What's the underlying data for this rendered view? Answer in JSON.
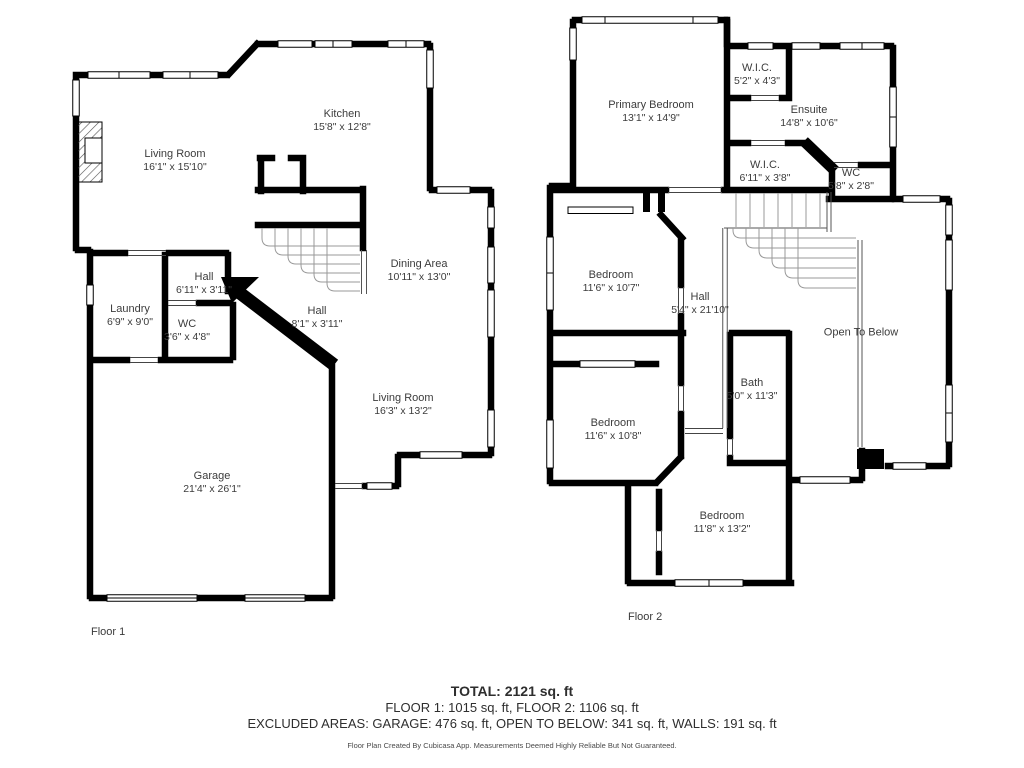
{
  "floor1": {
    "caption": "Floor 1",
    "rooms": {
      "living_room": {
        "name": "Living Room",
        "dims": "16'1\" x 15'10\""
      },
      "kitchen": {
        "name": "Kitchen",
        "dims": "15'8\" x 12'8\""
      },
      "dining_area": {
        "name": "Dining Area",
        "dims": "10'11\" x 13'0\""
      },
      "hall_small": {
        "name": "Hall",
        "dims": "6'11\" x 3'11\""
      },
      "laundry": {
        "name": "Laundry",
        "dims": "6'9\" x 9'0\""
      },
      "wc": {
        "name": "WC",
        "dims": "3'6\" x 4'8\""
      },
      "hall_diag": {
        "name": "Hall",
        "dims": "8'1\" x 3'11\""
      },
      "living_room2": {
        "name": "Living Room",
        "dims": "16'3\" x 13'2\""
      },
      "garage": {
        "name": "Garage",
        "dims": "21'4\" x 26'1\""
      }
    }
  },
  "floor2": {
    "caption": "Floor 2",
    "rooms": {
      "primary_bedroom": {
        "name": "Primary Bedroom",
        "dims": "13'1\" x 14'9\""
      },
      "wic1": {
        "name": "W.I.C.",
        "dims": "5'2\" x 4'3\""
      },
      "ensuite": {
        "name": "Ensuite",
        "dims": "14'8\" x 10'6\""
      },
      "wic2": {
        "name": "W.I.C.",
        "dims": "6'11\" x 3'8\""
      },
      "wc": {
        "name": "WC",
        "dims": "5'8\" x 2'8\""
      },
      "bedroom1": {
        "name": "Bedroom",
        "dims": "11'6\" x 10'7\""
      },
      "hall": {
        "name": "Hall",
        "dims": "5'4\" x 21'10\""
      },
      "open_to_below": {
        "name": "Open To Below"
      },
      "bedroom2": {
        "name": "Bedroom",
        "dims": "11'6\" x 10'8\""
      },
      "bath": {
        "name": "Bath",
        "dims": "5'0\" x 11'3\""
      },
      "bedroom3": {
        "name": "Bedroom",
        "dims": "11'8\" x 13'2\""
      }
    }
  },
  "summary": {
    "total": "TOTAL: 2121 sq. ft",
    "floors": "FLOOR 1: 1015 sq. ft, FLOOR 2: 1106 sq. ft",
    "excluded": "EXCLUDED AREAS: GARAGE: 476 sq. ft, OPEN TO BELOW: 341 sq. ft, WALLS: 191 sq. ft",
    "disclaimer": "Floor Plan Created By Cubicasa App. Measurements Deemed Highly Reliable But Not Guaranteed."
  },
  "colors": {
    "wall": "#000000",
    "text": "#3c3c3c",
    "stair_line": "#999999",
    "thin_line": "#555555"
  }
}
